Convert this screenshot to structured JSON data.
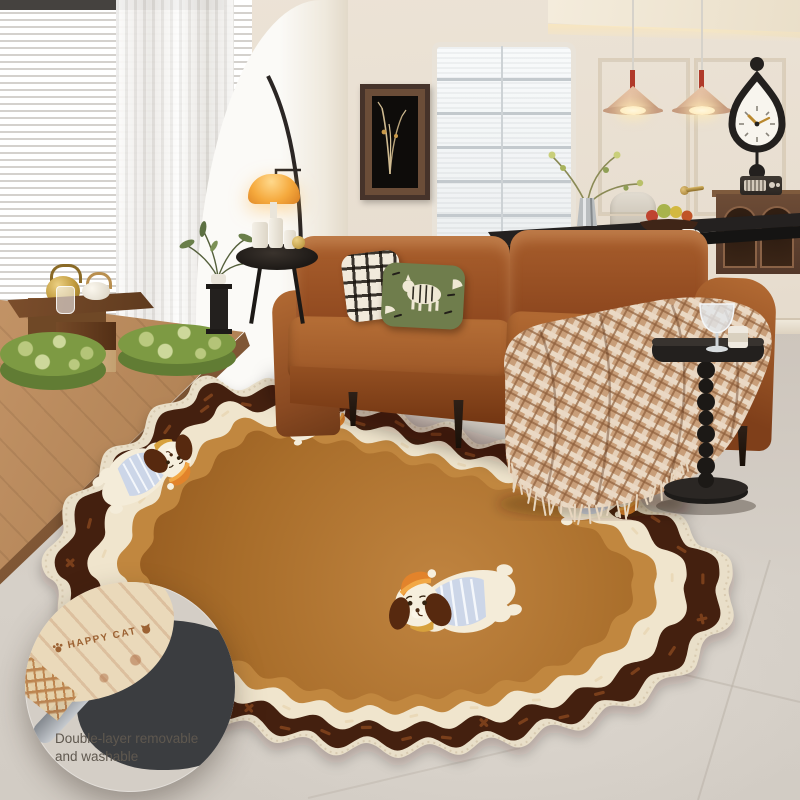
{
  "callout": {
    "brand_label": "HAPPY CAT",
    "caption_line1": "Double-layer removable",
    "caption_line2": "and washable",
    "icons": [
      "paw-icon",
      "cat-face-icon"
    ]
  },
  "rug": {
    "motif": "cartoon puppies with orange caps and striped shirts",
    "dog_count": 4,
    "colors": {
      "field": "#ae7231",
      "field_light": "#c08440",
      "field_dark": "#93591f",
      "band_caramel": "#c1873f",
      "band_cream": "#f0e5cd",
      "band_dark": "#44200f",
      "trim": "#e9dfc9",
      "dash_brown": "#7a3f1b",
      "dash_cream": "#ead9b8"
    }
  },
  "palette": {
    "wall": "#e9dfd0",
    "arch": "#faf8f4",
    "floor": "#d3ccc4",
    "sofa_leather": "#a45c2b",
    "sofa_shadow": "#72390f",
    "throw_plaid_base": "#c89e79",
    "throw_plaid_line": "#ead9c4",
    "pillow_plaid": "#f1eadb",
    "pillow_zebra_green": "#6f7d4c",
    "platform_wood": "#b98c5e",
    "cushion_green": "#7d9a43",
    "tea_table_wood": "#6e4426",
    "lamp_glass_orange": "#f5a93d",
    "pendant_shade": "#d7ae8e",
    "accent_red": "#b03a2a",
    "black": "#23201e",
    "gold": "#c09a4a"
  }
}
